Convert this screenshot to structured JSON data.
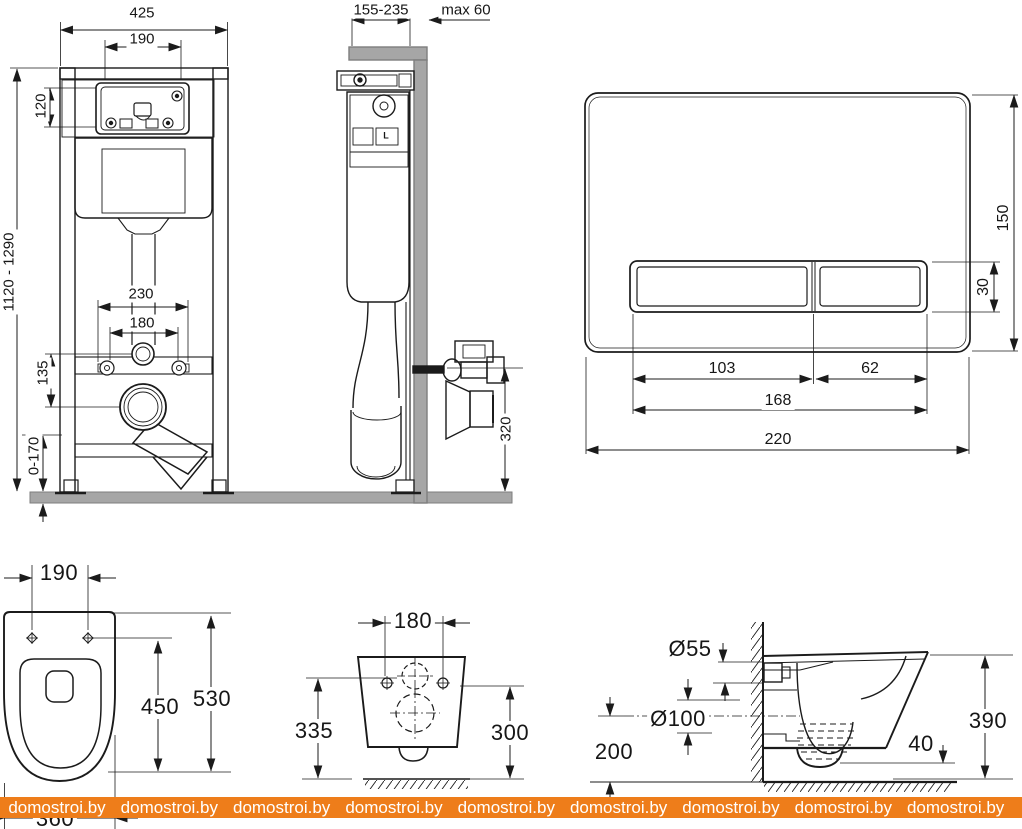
{
  "watermark": {
    "text": "domostroi.by",
    "repeats": 10,
    "band_color": "#ee7d1a",
    "text_color": "#ffffff"
  },
  "colors": {
    "line": "#1b1b1b",
    "wall_fill": "#a6a6a6",
    "wall_edge": "#7e7e7e",
    "background": "#ffffff"
  },
  "views": {
    "frame_front": {
      "dims": {
        "total_width": "425",
        "opening_width": "190",
        "service_opening_height": "120",
        "frame_height_range": "1120 - 1290",
        "fixing_spacing_outer": "230",
        "fixing_spacing_inner": "180",
        "inlet_to_outlet": "135",
        "foot_adjustment": "0-170"
      }
    },
    "frame_side": {
      "dims": {
        "frame_depth_range": "155-235",
        "max_facing": "max 60",
        "outlet_height": "320"
      },
      "labels": {
        "valve": "L"
      }
    },
    "flush_plate": {
      "dims": {
        "plate_width": "220",
        "plate_height": "150",
        "large_button_width": "103",
        "small_button_width": "62",
        "buttons_width": "168",
        "button_height": "30"
      }
    },
    "bowl_top": {
      "dims": {
        "fixing_spacing": "190",
        "inner_length": "450",
        "total_length": "530",
        "width": "360"
      }
    },
    "bowl_back": {
      "dims": {
        "fixing_spacing": "180",
        "left_height": "335",
        "right_height": "300"
      }
    },
    "bowl_side": {
      "dims": {
        "inlet_diameter": "Ø55",
        "outlet_diameter": "Ø100",
        "outlet_axis_height": "200",
        "total_height": "390",
        "rim_offset": "40"
      }
    }
  }
}
